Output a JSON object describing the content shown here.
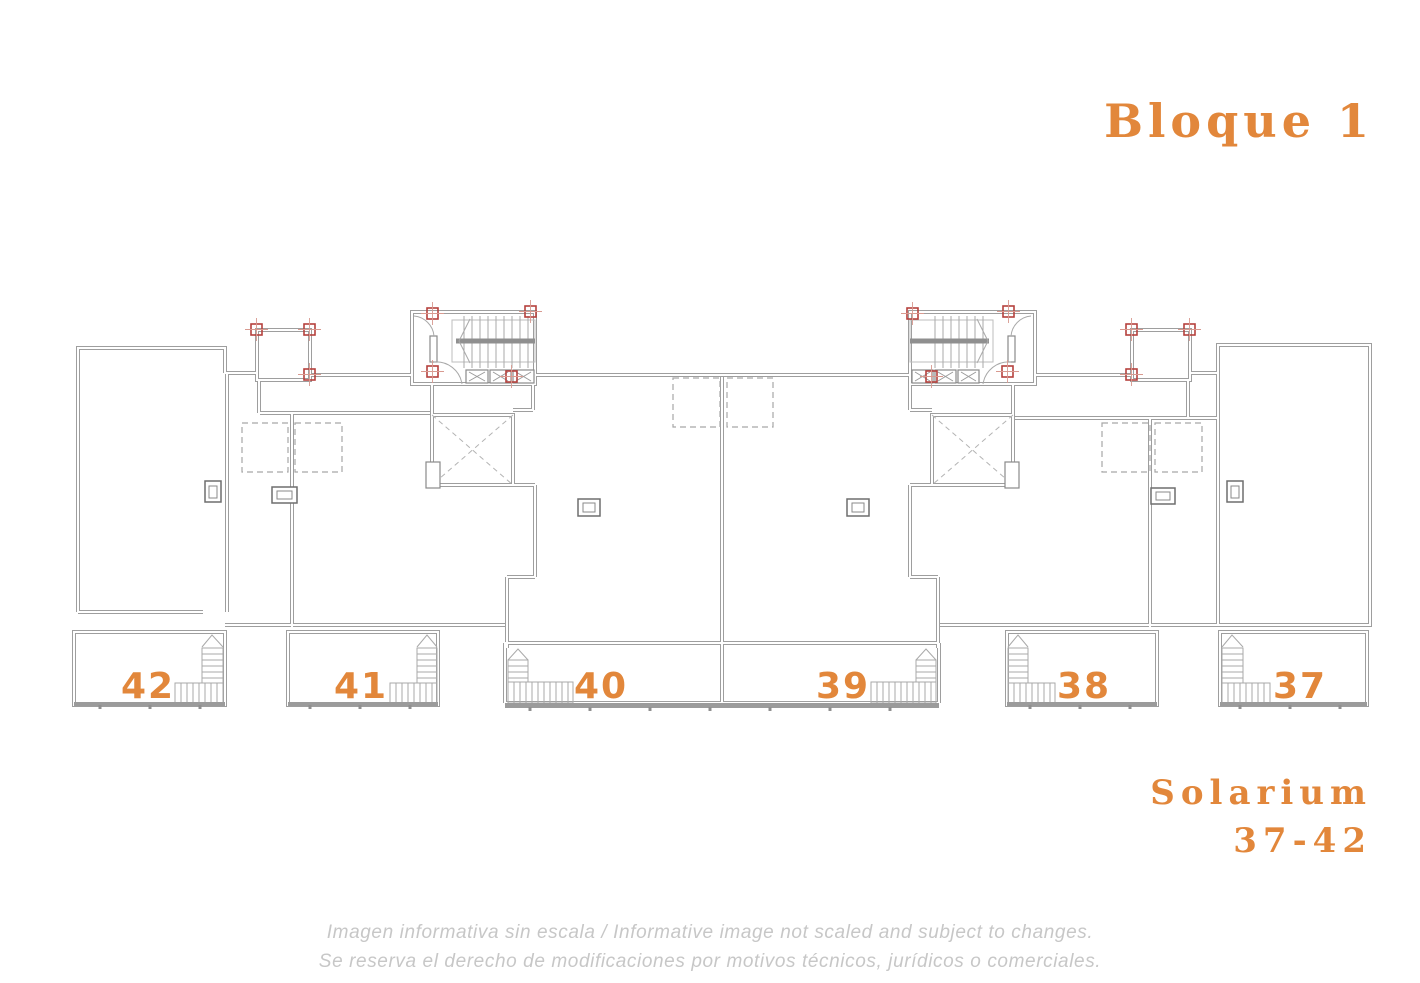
{
  "header": {
    "title": "Bloque 1"
  },
  "plan": {
    "units": [
      {
        "label": "42"
      },
      {
        "label": "41"
      },
      {
        "label": "40"
      },
      {
        "label": "39"
      },
      {
        "label": "38"
      },
      {
        "label": "37"
      }
    ],
    "solarium_line1": "Solarium",
    "solarium_line2": "37-42"
  },
  "footer": {
    "line1": "Imagen informativa sin escala /  Informative image not scaled and subject to changes.",
    "line2": "Se reserva el derecho de modificaciones por motivos técnicos, jurídicos o comerciales."
  },
  "colors": {
    "accent_orange": "#e2873b",
    "wall_gray": "#9e9e9e",
    "column_red": "#b5413d",
    "footer_gray": "#c7c7c7"
  }
}
